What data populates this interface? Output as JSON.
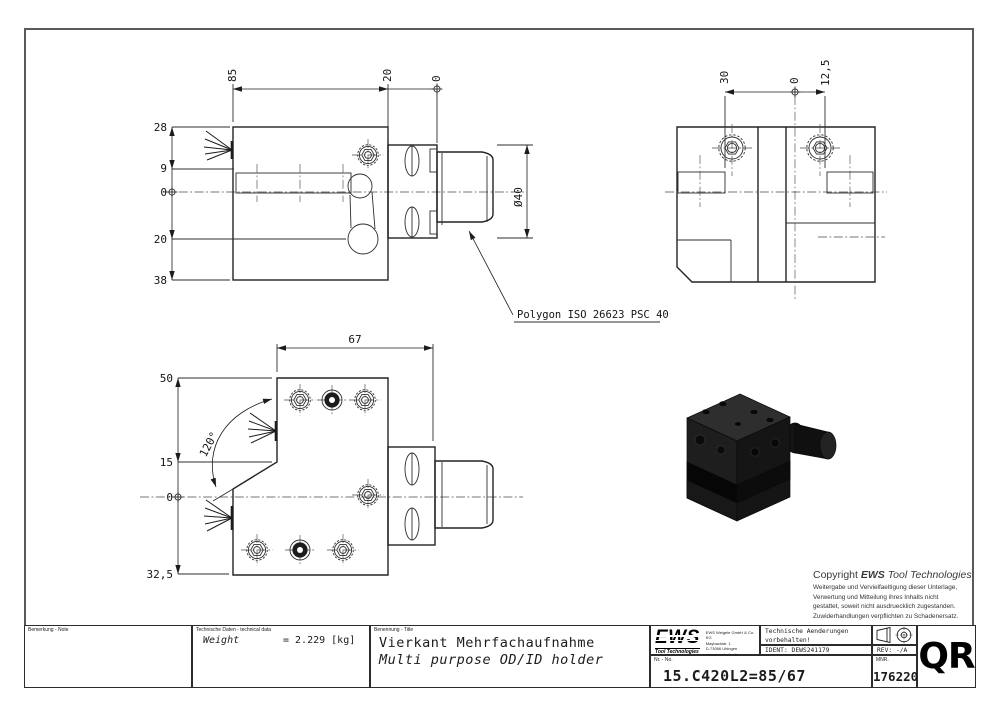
{
  "views": {
    "front": {
      "top": [
        "85",
        "20",
        "0"
      ],
      "left": [
        "28",
        "9",
        "0",
        "20",
        "38"
      ],
      "diameter": "Ø40"
    },
    "side": {
      "top": [
        "30",
        "0",
        "12,5"
      ]
    },
    "bottom": {
      "top": "67",
      "left": [
        "50",
        "15",
        "0",
        "32,5"
      ],
      "angle": "120°"
    },
    "callout": "Polygon ISO 26623 PSC 40"
  },
  "copyright": {
    "prefix": "Copyright ",
    "brand": "EWS",
    "suffix": " Tool Technologies",
    "lines": [
      "Weitergabe und Vervielfaeltigung dieser Unterlage,",
      "Verwertung und Mitteilung ihres Inhalts nicht",
      "gestattet, soweit nicht ausdruecklich zugestanden.",
      "Zuwiderhandlungen verpflichten zu Schadenersatz."
    ]
  },
  "title_block": {
    "note_label": "Bemerkung - Note",
    "tech_label": "Technische Daten - technical data",
    "weight_label": "Weight",
    "weight_value": "=  2.229 [kg]",
    "name_label": "Benennung - Title",
    "title_de": "Vierkant Mehrfachaufnahme",
    "title_en": "Multi purpose OD/ID holder",
    "logo": "EWS",
    "logo_sub": "Tool Technologies",
    "address": [
      "EWS Weigele GmbH & Co. KG",
      "Maybachstr. 1",
      "D-73066 Uhingen",
      "www.ews-tools.de"
    ],
    "mod_de": "Technische Aenderungen vorbehalten!",
    "mod_en": "Subject to technical modifications!",
    "ident": "IDENT:  DEWS241179",
    "rev": "REV:  -/A",
    "no_label": "Nr. - No.",
    "no_value": "15.C420L2=85/67",
    "mnr_label": "MNR.",
    "mnr_value": "176220",
    "qr": "QR"
  },
  "colors": {
    "line": "#232323",
    "render_body": "#1e1e1e",
    "paper": "#ffffff"
  }
}
